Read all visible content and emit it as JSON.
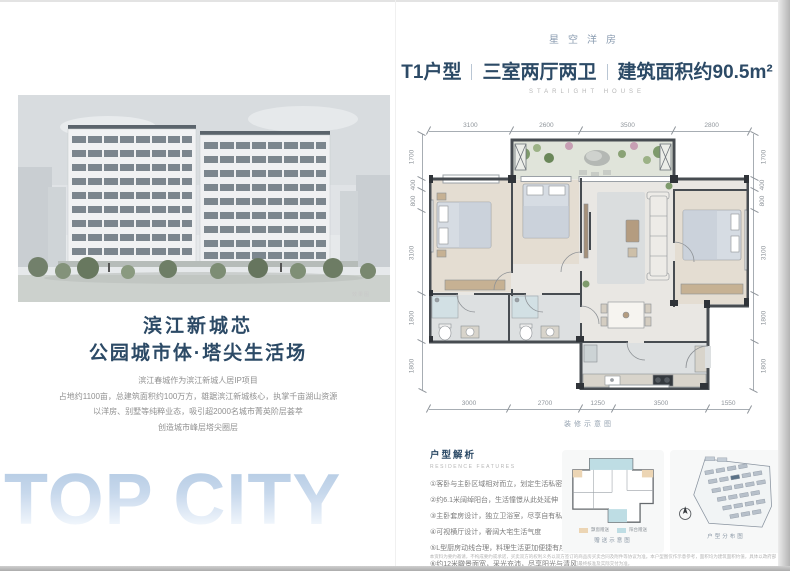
{
  "colors": {
    "accent_navy": "#2c4a66",
    "eyebrow_blue": "#8b9db1",
    "topcity_gradient_top": "#b2c9e2",
    "wall_gray": "#474c51",
    "legend_orange": "#ecd5b4",
    "legend_blue": "#bedde4"
  },
  "left_panel": {
    "render_caption": "效果图",
    "headline_line1": "滨江新城芯",
    "headline_line2": "公园城市体·塔尖生活场",
    "paragraph": [
      "滨江春城作为滨江新城人居IP项目",
      "占地约1100亩，总建筑面积约100万方，雄踞滨江新城核心，执掌千亩湖山资源",
      "以洋房、别墅等纯粹业态，吸引超2000名城市菁英阶层荟萃",
      "创造城市峰层塔尖圈层"
    ],
    "watermark": "TOP CITY"
  },
  "right_panel": {
    "eyebrow": "星空洋房",
    "title": {
      "part1": "T1户型",
      "part2": "三室两厅两卫",
      "part3": "建筑面积约90.5m²"
    },
    "subtitle_en": "STARLIGHT HOUSE",
    "floorplan": {
      "dims_top": [
        "3100",
        "2600",
        "3500",
        "2800"
      ],
      "dims_bottom": [
        "3000",
        "2700",
        "1250",
        "3500",
        "1550"
      ],
      "dims_left": [
        "1700",
        "400",
        "800",
        "3100",
        "1800",
        "1800"
      ],
      "dims_right": [
        "1700",
        "400",
        "800",
        "3100",
        "1800",
        "1800"
      ],
      "caption": "装修示意图"
    },
    "features": {
      "title": "户型解析",
      "subtitle_en": "RESIDENCE FEATURES",
      "items": [
        "①客卧与主卧区域相对而立，划定生活私密",
        "②约6.1米阔绰阳台，生活憧憬从此处延伸",
        "③主卧套房设计，独立卫浴室，尽享自有私密尺度",
        "④可视横厅设计，奢阔大宅生活气度",
        "⑤L型厨房动线合理，料理生活更加便捷有序",
        "⑥约12米瞰景面宽，采光充沛，尽享阳光与清风"
      ]
    },
    "mini_structure": {
      "caption": "赠送示意图",
      "legend": [
        {
          "label": "飘窗赠送"
        },
        {
          "label": "阳台赠送"
        }
      ]
    },
    "mini_siteplan": {
      "caption": "户型分布图"
    },
    "disclaimer": [
      "本资料为要约邀请，不构成要约或承诺，买卖双方的权利义务以双方签订的商品房买卖合同及附件等协议为准。本户型图仅作示意参考，面积均为建筑面积约值，具体以政府部门最终核准及实际交付为准。",
      "部分装修、家具及软装仅为示意展示，不属于交付标准；相关配套信息仅供参考，不作为交付承诺。本资料制作时间有限，若有变动恕不另行通知，详情请垂询营销中心。"
    ]
  }
}
